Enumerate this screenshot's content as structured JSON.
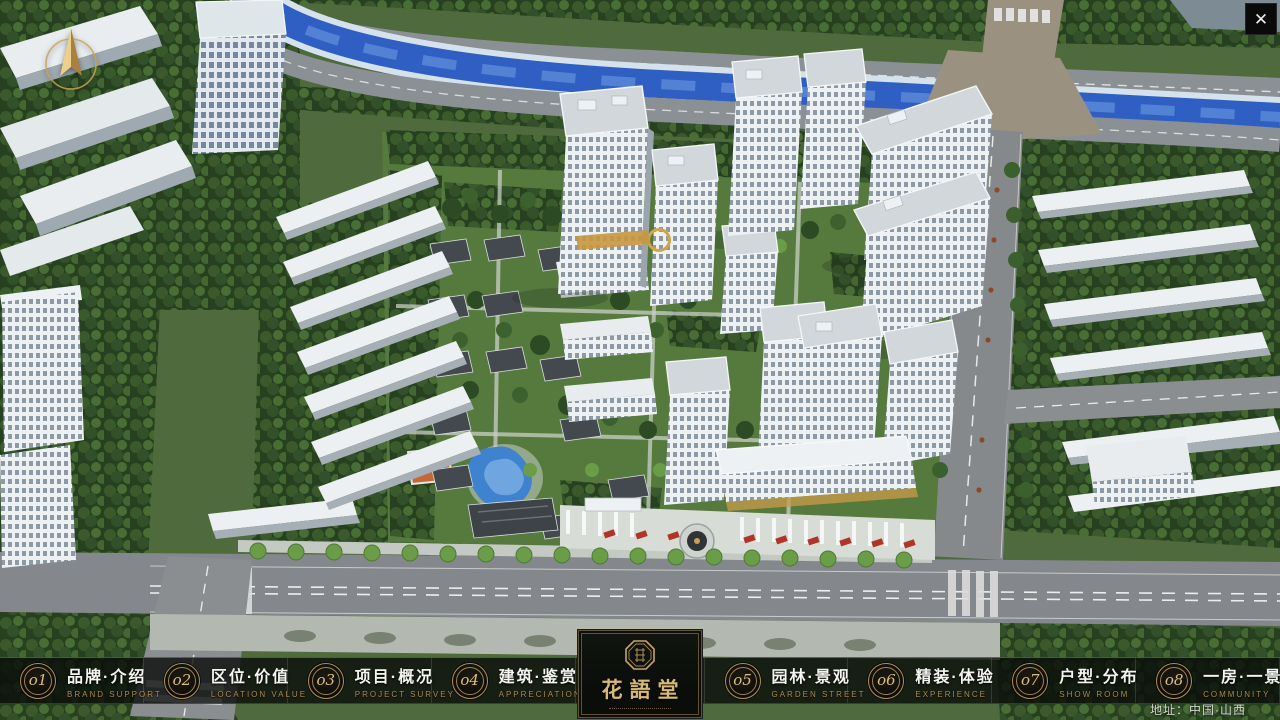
{
  "window": {
    "close_label": "✕"
  },
  "nav": {
    "items": [
      {
        "number": "o1",
        "label": "品牌·介绍",
        "sublabel": "BRAND SUPPORT"
      },
      {
        "number": "o2",
        "label": "区位·价值",
        "sublabel": "LOCATION VALUE"
      },
      {
        "number": "o3",
        "label": "项目·概况",
        "sublabel": "PROJECT SURVEY"
      },
      {
        "number": "o4",
        "label": "建筑·鉴赏",
        "sublabel": "APPRECIATION"
      },
      {
        "number": "o5",
        "label": "园林·景观",
        "sublabel": "GARDEN STREET"
      },
      {
        "number": "o6",
        "label": "精装·体验",
        "sublabel": "EXPERIENCE"
      },
      {
        "number": "o7",
        "label": "户型·分布",
        "sublabel": "SHOW ROOM"
      },
      {
        "number": "o8",
        "label": "一房·一景",
        "sublabel": "COMMUNITY"
      }
    ]
  },
  "logo": {
    "title": "花語堂"
  },
  "footer": {
    "address": "地址：中国·山西"
  },
  "colors": {
    "accent_gold": "#c9a45e",
    "nav_text": "#f4f4f0",
    "nav_english": "#ab8a50",
    "panel_bg": "#0b0e0b",
    "river_blue": "#2f5fc2"
  }
}
